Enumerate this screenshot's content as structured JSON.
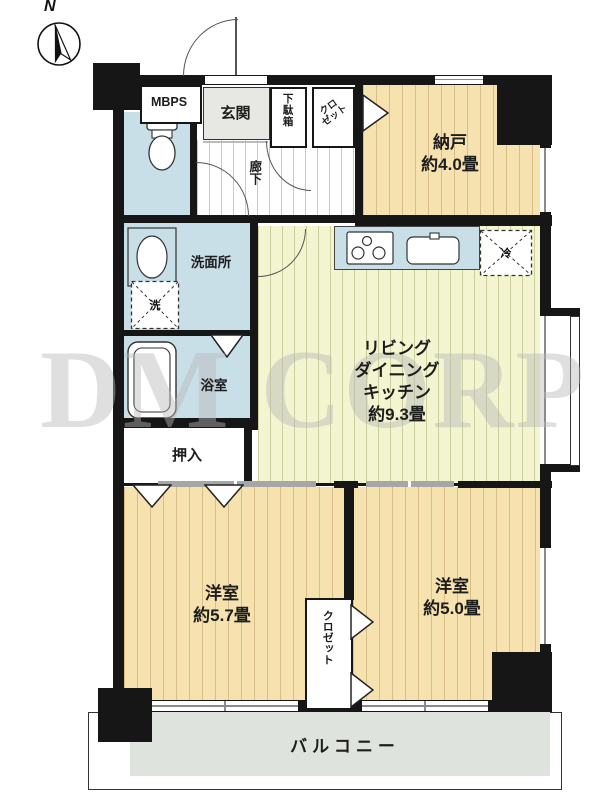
{
  "compass": {
    "label": "N"
  },
  "watermark": "DM CORP",
  "rooms": {
    "mbps": {
      "label": "MBPS"
    },
    "genkan": {
      "label": "玄関"
    },
    "getabako": {
      "label": "下駄箱"
    },
    "closet_top": {
      "line1": "クロ",
      "line2": "ゼット"
    },
    "nando": {
      "name": "納戸",
      "size": "約4.0畳"
    },
    "hallway": {
      "label": "廊下"
    },
    "senmenjo": {
      "label": "洗面所"
    },
    "yokushitsu": {
      "label": "浴室"
    },
    "oshiire": {
      "label": "押入"
    },
    "ldk": {
      "line1": "リビング",
      "line2": "ダイニング",
      "line3": "キッチン",
      "size": "約9.3畳"
    },
    "bedroom_57": {
      "name": "洋室",
      "size": "約5.7畳"
    },
    "bedroom_50": {
      "name": "洋室",
      "size": "約5.0畳"
    },
    "closet_bottom": {
      "label": "クロゼット"
    },
    "balcony": {
      "label": "バルコニー"
    }
  },
  "fixtures": {
    "fridge_label": "冷",
    "washer_label": "洗"
  },
  "colors": {
    "wall": "#161616",
    "wood_room": "#F5E2AE",
    "ldk_room": "#F3F4D0",
    "wet_room": "#C9DFE8",
    "genkan": "#E7E8E3",
    "balcony": "#DFE3DD",
    "watermark": "#B9B9B9"
  }
}
